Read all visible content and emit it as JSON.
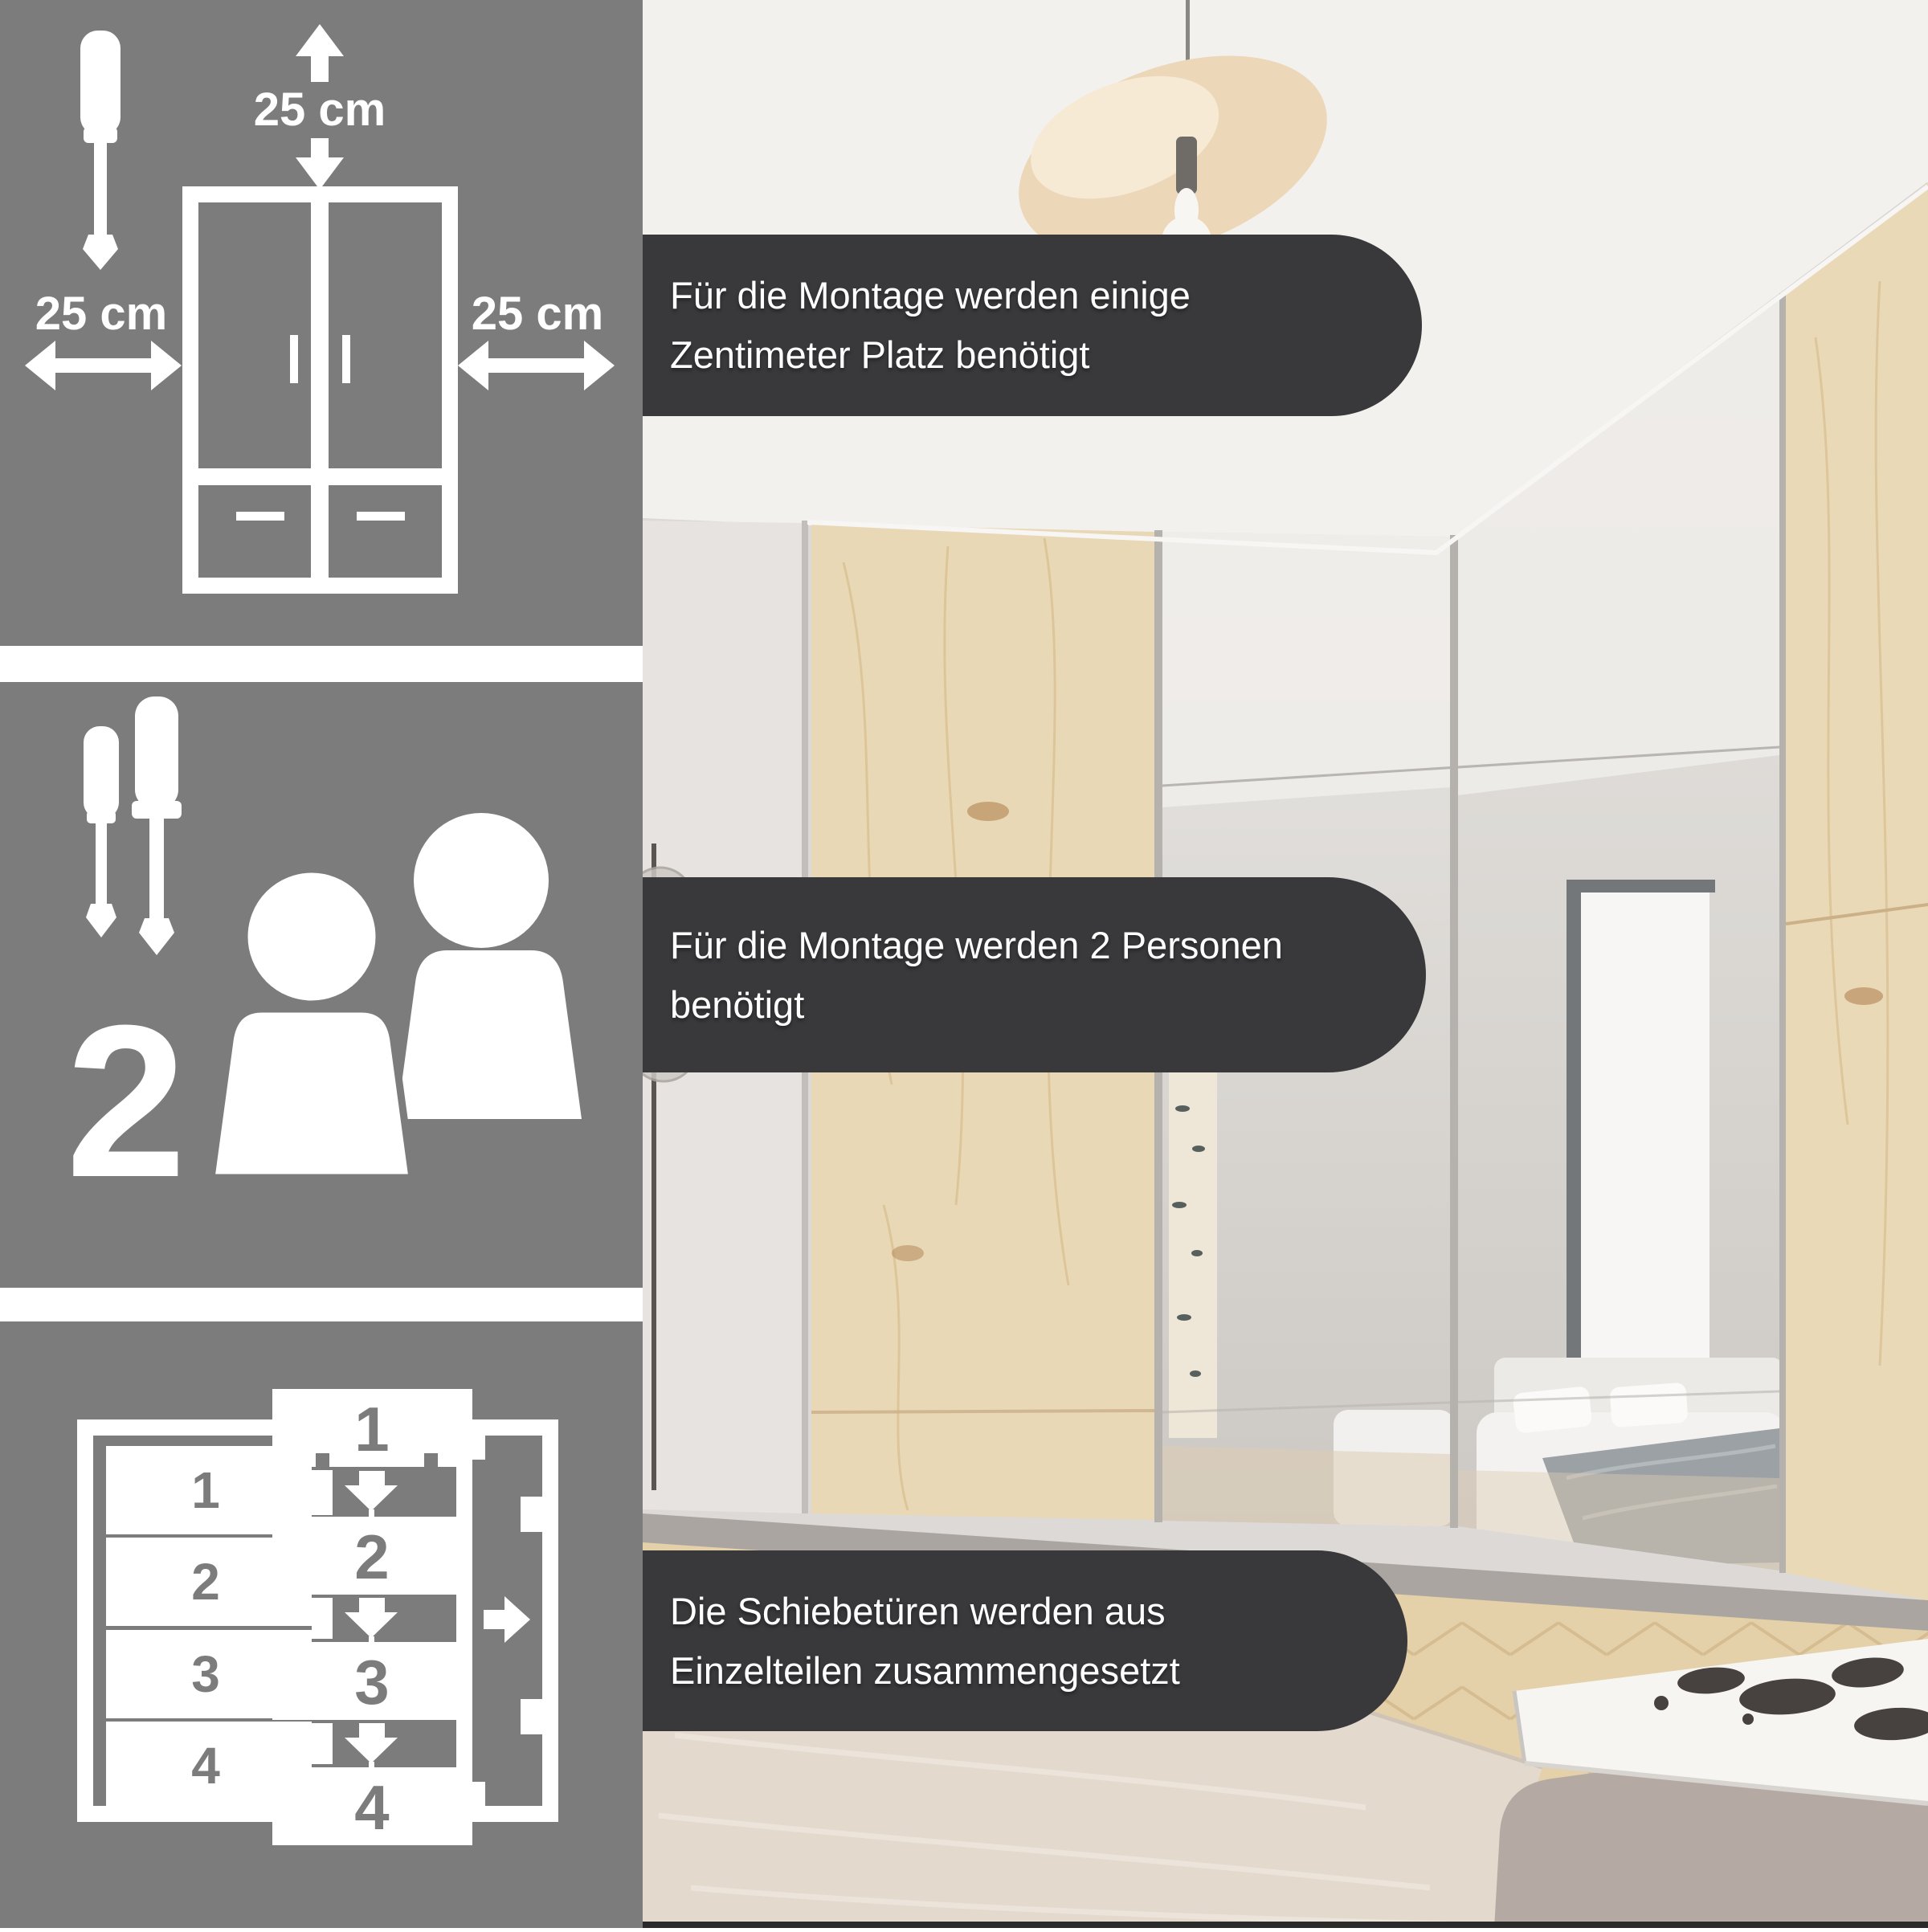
{
  "colors": {
    "panel_bg": "#7c7c7c",
    "banner_bg": "#39393b",
    "pictogram": "#ffffff",
    "banner_text": "#ffffff",
    "wood": "#e9d8b6",
    "mirror": "#d6d3cf",
    "rug": "#e3d9cc",
    "floor": "#e4d0a9"
  },
  "clearance_panel": {
    "top_label": "25 cm",
    "left_label": "25 cm",
    "right_label": "25 cm"
  },
  "persons_panel": {
    "count": "2"
  },
  "assembly_panel": {
    "door_slats": [
      "1",
      "2",
      "3",
      "4"
    ],
    "stack_parts": [
      "1",
      "2",
      "3",
      "4"
    ]
  },
  "banners": [
    {
      "line1": "Für die Montage werden einige",
      "line2": "Zentimeter Platz benötigt"
    },
    {
      "line1": "Für die Montage werden 2 Personen",
      "line2": "benötigt"
    },
    {
      "line1": "Die Schiebetüren werden aus",
      "line2": "Einzelteilen zusammengesetzt"
    }
  ]
}
